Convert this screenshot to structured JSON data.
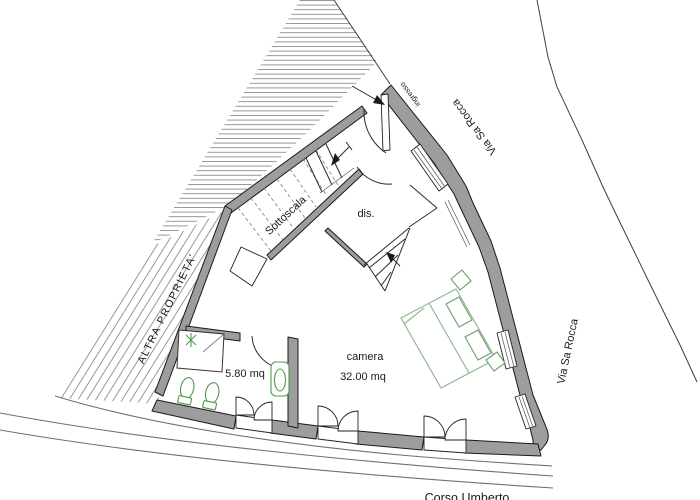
{
  "labels": {
    "other_property": "ALTRA PROPRIETA'",
    "street_top": "Via Sa Rocca",
    "street_right": "Via Sa Rocca",
    "street_bottom": "Corso Umberto",
    "entrance": "ingresso",
    "understairs": "Sottoscala",
    "hallway": "dis.",
    "bedroom": "camera",
    "bedroom_area": "32.00 mq",
    "bathroom_area": "5.80 mq"
  },
  "colors": {
    "wall": "#9d9d9d",
    "outline": "#1a1a1a",
    "fixture_green": "#4f9a4f",
    "bed_green": "#93b893",
    "hatch": "#8c8c8c",
    "street_line": "#707070",
    "boundary": "#3f3f3f"
  }
}
